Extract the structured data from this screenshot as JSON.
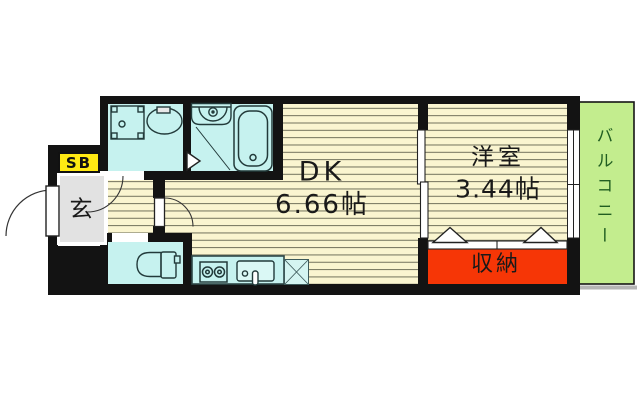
{
  "floor_plan": {
    "rooms": {
      "dk": {
        "name": "DK",
        "size": "6.66帖"
      },
      "western_room": {
        "name": "洋室",
        "size": "3.44帖"
      },
      "storage": {
        "label": "収納"
      },
      "balcony": {
        "label": "バルコニー"
      },
      "entrance": {
        "label": "玄"
      },
      "shoe_box": {
        "label": "SB"
      }
    },
    "fixtures": [
      "washing-machine-pan",
      "washbasin",
      "bathroom-vanity",
      "bathtub",
      "toilet",
      "gas-stove-2-burner",
      "kitchen-sink",
      "refrigerator-space",
      "closet-sliding-doors",
      "entrance-door",
      "sliding-door-dk-western",
      "window-western-balcony"
    ],
    "colors": {
      "wall": "#131313",
      "wet_room_fill": "#c6f2ef",
      "floor_fill": "#faf5d0",
      "floor_stripe": "#72725c",
      "storage_fill": "#f63606",
      "balcony_fill": "#c3ed8e",
      "balcony_text": "#215e21",
      "shoe_box_fill": "#ffe913",
      "entrance_fill": "#e2e2e2"
    }
  }
}
